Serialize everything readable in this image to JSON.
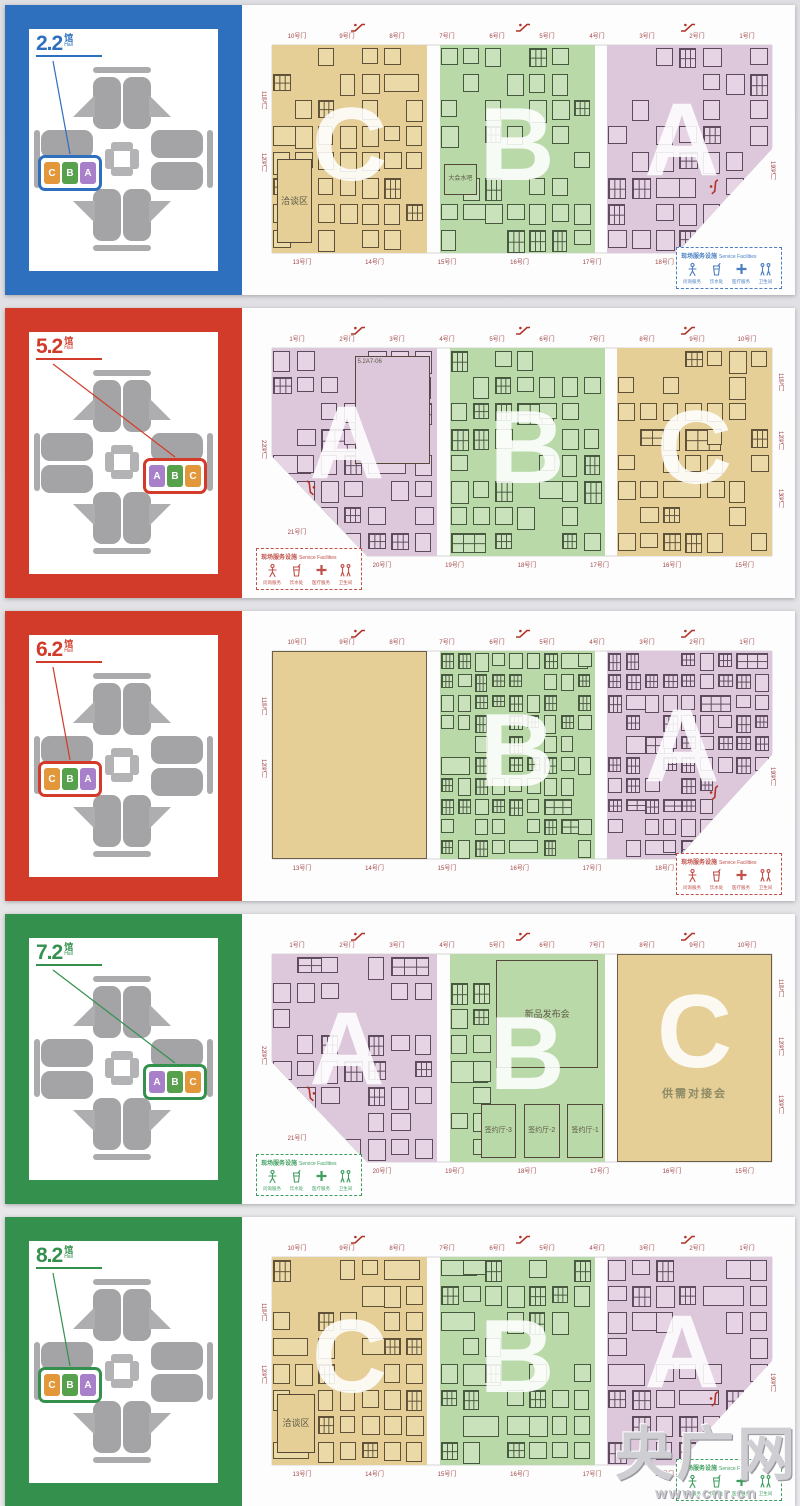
{
  "watermark": {
    "name": "央广网",
    "url": "www.cnr.cn"
  },
  "legend": {
    "title_cn": "现场服务设施",
    "title_en": "Service Facilities",
    "items": [
      {
        "icon": "info-desk-icon",
        "label": "问询服务"
      },
      {
        "icon": "water-icon",
        "label": "饮水处"
      },
      {
        "icon": "medical-icon",
        "label": "医疗服务"
      },
      {
        "icon": "restroom-icon",
        "label": "卫生间"
      }
    ]
  },
  "halls": [
    {
      "number": "2.2",
      "suffix_cn": "馆",
      "suffix_en": "Hall",
      "accent": "#2e6fbe",
      "legend_accent": "#4a7fc1",
      "minimap_side": "left",
      "cut": "right",
      "legend_pos": "right",
      "chips": [
        {
          "letter": "C",
          "color": "#e2973b"
        },
        {
          "letter": "B",
          "color": "#57a04c"
        },
        {
          "letter": "A",
          "color": "#a87fc9"
        }
      ],
      "zones": [
        {
          "letter": "C",
          "palette": "tan",
          "booths": true,
          "labels": [
            {
              "text": "洽谈区",
              "x": 3,
              "y": 55,
              "w": 23,
              "h": 40,
              "fs": 9
            }
          ]
        },
        {
          "letter": "B",
          "palette": "green",
          "booths": true,
          "labels": [
            {
              "text": "大会水吧",
              "x": 3,
              "y": 57,
              "w": 21,
              "h": 15,
              "fs": 6
            }
          ]
        },
        {
          "letter": "A",
          "palette": "purple",
          "booths": true,
          "cut": true,
          "labels": []
        }
      ],
      "gates_top": [
        "10号门",
        "9号门",
        "8号门",
        "7号门",
        "6号门",
        "5号门",
        "4号门",
        "3号门",
        "2号门",
        "1号门"
      ],
      "gates_bottom": [
        "13号门",
        "14号门",
        "15号门",
        "16号门",
        "17号门",
        "18号门"
      ],
      "gates_left": [
        "11号门",
        "12号门"
      ],
      "gates_right": [],
      "gate_corner": "19号门",
      "gate_notch": ""
    },
    {
      "number": "5.2",
      "suffix_cn": "馆",
      "suffix_en": "Hall",
      "accent": "#d23b2a",
      "legend_accent": "#c05048",
      "minimap_side": "right",
      "cut": "left",
      "legend_pos": "left",
      "chips": [
        {
          "letter": "A",
          "color": "#a87fc9"
        },
        {
          "letter": "B",
          "color": "#57a04c"
        },
        {
          "letter": "C",
          "color": "#e2973b"
        }
      ],
      "zones": [
        {
          "letter": "A",
          "palette": "purple",
          "booths": true,
          "cut": true,
          "labels": [
            {
              "text": "5.2A7-06",
              "x": 50,
              "y": 4,
              "w": 46,
              "h": 52,
              "fs": 6,
              "outline": true
            }
          ]
        },
        {
          "letter": "B",
          "palette": "green",
          "booths": true,
          "labels": []
        },
        {
          "letter": "C",
          "palette": "tan",
          "booths": true,
          "labels": []
        }
      ],
      "gates_top": [
        "1号门",
        "2号门",
        "3号门",
        "4号门",
        "5号门",
        "6号门",
        "7号门",
        "8号门",
        "9号门",
        "10号门"
      ],
      "gates_bottom": [
        "20号门",
        "19号门",
        "18号门",
        "17号门",
        "16号门",
        "15号门"
      ],
      "gates_left": [],
      "gates_right": [
        "11号门",
        "12号门",
        "13号门"
      ],
      "gate_corner": "21号门",
      "gate_notch": "22号门"
    },
    {
      "number": "6.2",
      "suffix_cn": "馆",
      "suffix_en": "Hall",
      "accent": "#d23b2a",
      "legend_accent": "#c05048",
      "minimap_side": "left",
      "cut": "right",
      "legend_pos": "right",
      "chips": [
        {
          "letter": "C",
          "color": "#e2973b"
        },
        {
          "letter": "B",
          "color": "#57a04c"
        },
        {
          "letter": "A",
          "color": "#a87fc9"
        }
      ],
      "zones": [
        {
          "letter": "",
          "palette": "tan",
          "booths": false,
          "plain": true,
          "labels": []
        },
        {
          "letter": "B",
          "palette": "green",
          "booths": true,
          "dense": true,
          "labels": []
        },
        {
          "letter": "A",
          "palette": "purple",
          "booths": true,
          "dense": true,
          "cut": true,
          "labels": []
        }
      ],
      "gates_top": [
        "10号门",
        "9号门",
        "8号门",
        "7号门",
        "6号门",
        "5号门",
        "4号门",
        "3号门",
        "2号门",
        "1号门"
      ],
      "gates_bottom": [
        "13号门",
        "14号门",
        "15号门",
        "16号门",
        "17号门",
        "18号门"
      ],
      "gates_left": [
        "11号门",
        "12号门"
      ],
      "gates_right": [],
      "gate_corner": "19号门",
      "gate_notch": ""
    },
    {
      "number": "7.2",
      "suffix_cn": "馆",
      "suffix_en": "Hall",
      "accent": "#33914d",
      "legend_accent": "#3f9e5f",
      "minimap_side": "right",
      "cut": "left",
      "legend_pos": "left",
      "chips": [
        {
          "letter": "A",
          "color": "#a87fc9"
        },
        {
          "letter": "B",
          "color": "#57a04c"
        },
        {
          "letter": "C",
          "color": "#e2973b"
        }
      ],
      "zones": [
        {
          "letter": "A",
          "palette": "purple",
          "booths": true,
          "cut": true,
          "labels": []
        },
        {
          "letter": "B",
          "palette": "green",
          "booths": true,
          "strip": 2,
          "labels": [
            {
              "text": "新品发布会",
              "x": 30,
              "y": 3,
              "w": 66,
              "h": 52,
              "fs": 9
            },
            {
              "text": "签约厅-3",
              "x": 20,
              "y": 72,
              "w": 23,
              "h": 26,
              "fs": 7
            },
            {
              "text": "签约厅-2",
              "x": 48,
              "y": 72,
              "w": 23,
              "h": 26,
              "fs": 7
            },
            {
              "text": "签约厅-1",
              "x": 76,
              "y": 72,
              "w": 23,
              "h": 26,
              "fs": 7
            }
          ]
        },
        {
          "letter": "C",
          "palette": "tan",
          "booths": false,
          "plain": true,
          "labels": [
            {
              "text": "供需对接会",
              "x": 10,
              "y": 60,
              "w": 80,
              "h": 14,
              "fs": 11,
              "textonly": true
            }
          ]
        }
      ],
      "gates_top": [
        "1号门",
        "2号门",
        "3号门",
        "4号门",
        "5号门",
        "6号门",
        "7号门",
        "8号门",
        "9号门",
        "10号门"
      ],
      "gates_bottom": [
        "20号门",
        "19号门",
        "18号门",
        "17号门",
        "16号门",
        "15号门"
      ],
      "gates_left": [],
      "gates_right": [
        "11号门",
        "12号门",
        "13号门"
      ],
      "gate_corner": "21号门",
      "gate_notch": "22号门"
    },
    {
      "number": "8.2",
      "suffix_cn": "馆",
      "suffix_en": "Hall",
      "accent": "#33914d",
      "legend_accent": "#3f9e5f",
      "minimap_side": "left",
      "cut": "right",
      "legend_pos": "right",
      "chips": [
        {
          "letter": "C",
          "color": "#e2973b"
        },
        {
          "letter": "B",
          "color": "#57a04c"
        },
        {
          "letter": "A",
          "color": "#a87fc9"
        }
      ],
      "zones": [
        {
          "letter": "C",
          "palette": "tan",
          "booths": true,
          "labels": [
            {
              "text": "洽谈区",
              "x": 3,
              "y": 66,
              "w": 25,
              "h": 28,
              "fs": 9
            }
          ]
        },
        {
          "letter": "B",
          "palette": "green",
          "booths": true,
          "labels": []
        },
        {
          "letter": "A",
          "palette": "purple",
          "booths": true,
          "cut": true,
          "labels": []
        }
      ],
      "gates_top": [
        "10号门",
        "9号门",
        "8号门",
        "7号门",
        "6号门",
        "5号门",
        "4号门",
        "3号门",
        "2号门",
        "1号门"
      ],
      "gates_bottom": [
        "13号门",
        "14号门",
        "15号门",
        "16号门",
        "17号门",
        "18号门"
      ],
      "gates_left": [
        "11号门",
        "12号门"
      ],
      "gates_right": [],
      "gate_corner": "19号门",
      "gate_notch": ""
    }
  ]
}
